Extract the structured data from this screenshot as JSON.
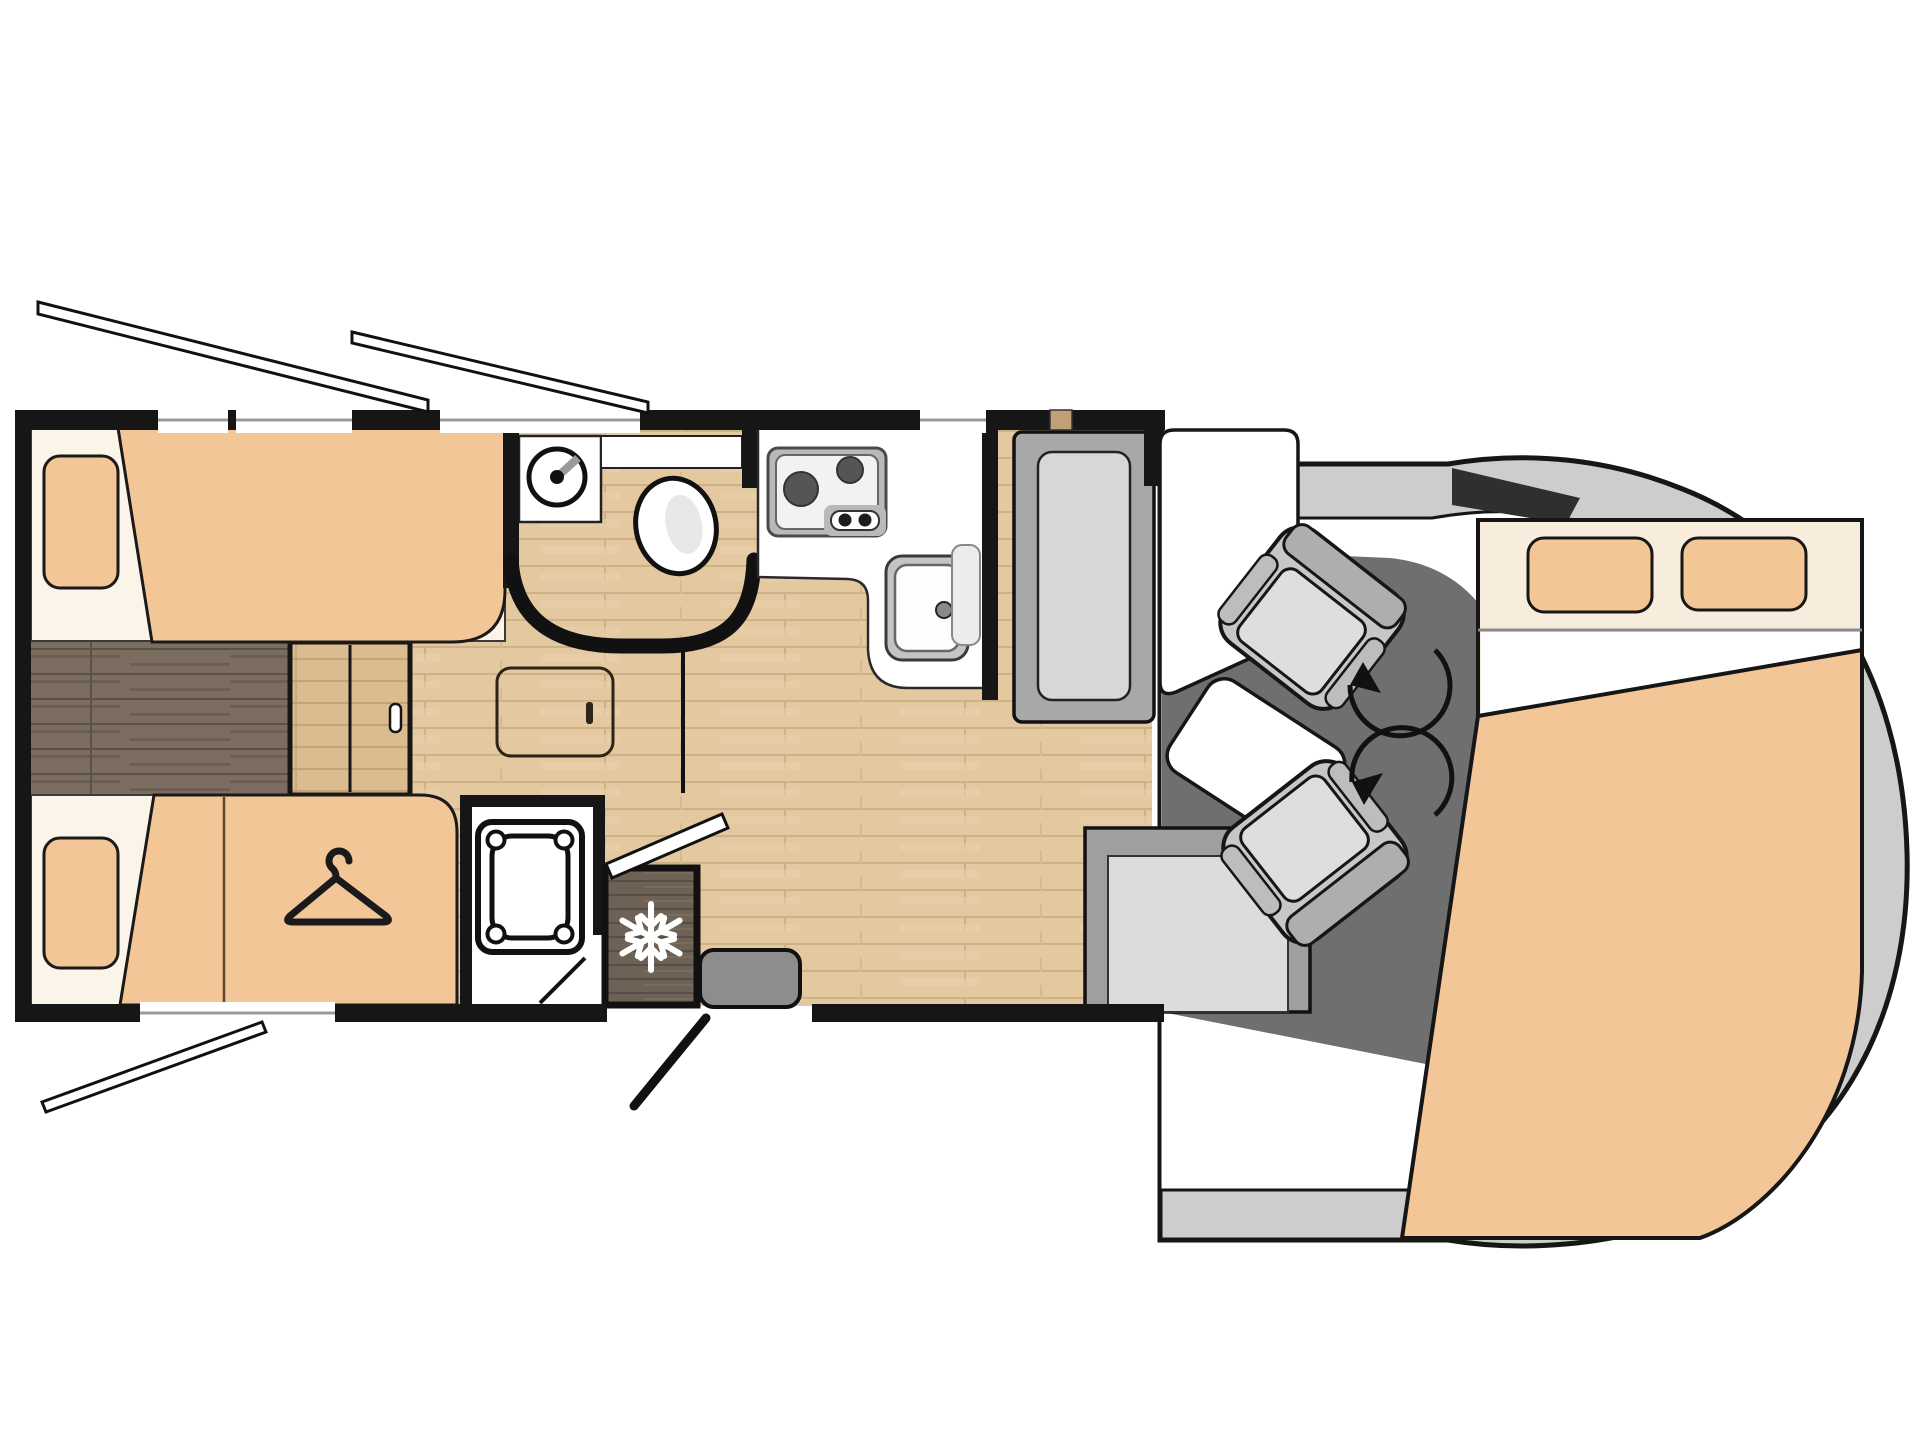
{
  "diagram": {
    "type": "floorplan",
    "subject": "motorhome-floor-plan",
    "orientation": "top-view, cab at right, rear bedroom at left",
    "colors": {
      "background": "#ffffff",
      "wall": "#161616",
      "floor_wood": "#e4c9a0",
      "floor_plank_line": "#cdb187",
      "walkway_dark_wood": "#7b6e60",
      "furniture_peach": "#f3c697",
      "bed_sheet_cream": "#fbf4e8",
      "overbed_cream": "#f8ecdc",
      "counter_white": "#ffffff",
      "appliance_gray": "#b9b9b9",
      "bench_gray": "#a8a8a8",
      "cushion_gray": "#d7d7d7",
      "cab_floor_gray": "#6f6f6f",
      "cab_body_gray": "#cdcdcd",
      "windshield_dark": "#2f2f2f",
      "fridge_dark_wood": "#6e6257",
      "snowflake": "#ffffff",
      "entry_mat_gray": "#8d8d8d"
    },
    "elements": {
      "plan": "motorhome floor plan",
      "rear_bed_top": "rear single bed top",
      "rear_bed_bottom": "rear single bed bottom",
      "walkway": "dark wood walkway between beds",
      "bed_steps": "step chest between beds",
      "wardrobe": "wardrobe with hanger",
      "shower": "shower cabin",
      "washbasin": "round washbasin on vanity",
      "toilet": "toilet",
      "bathroom": "washroom with curved wall",
      "hob": "two burner gas hob",
      "kitchen_sink": "kitchen sink",
      "kitchen_counter": "kitchen counter",
      "fridge": "fridge with freezer",
      "dinette_bench": "dinette bench seat",
      "dinette_table": "dinette table",
      "sideboard": "sideboard unit",
      "driver_seat": "swivel cab seat driver",
      "passenger_seat": "swivel cab seat passenger",
      "cab": "vehicle cab front with windshield",
      "drop_down_bed": "overcab drop-down double bed",
      "entry_door": "entry door open",
      "entry_mat": "entry step mat",
      "window_flap_rear_top_1": "open window flap",
      "window_flap_rear_top_2": "open window flap",
      "window_flap_rear_bottom": "open window flap"
    },
    "icons": [
      "hanger-icon",
      "snowflake-icon",
      "swivel-arrow-icon"
    ]
  }
}
